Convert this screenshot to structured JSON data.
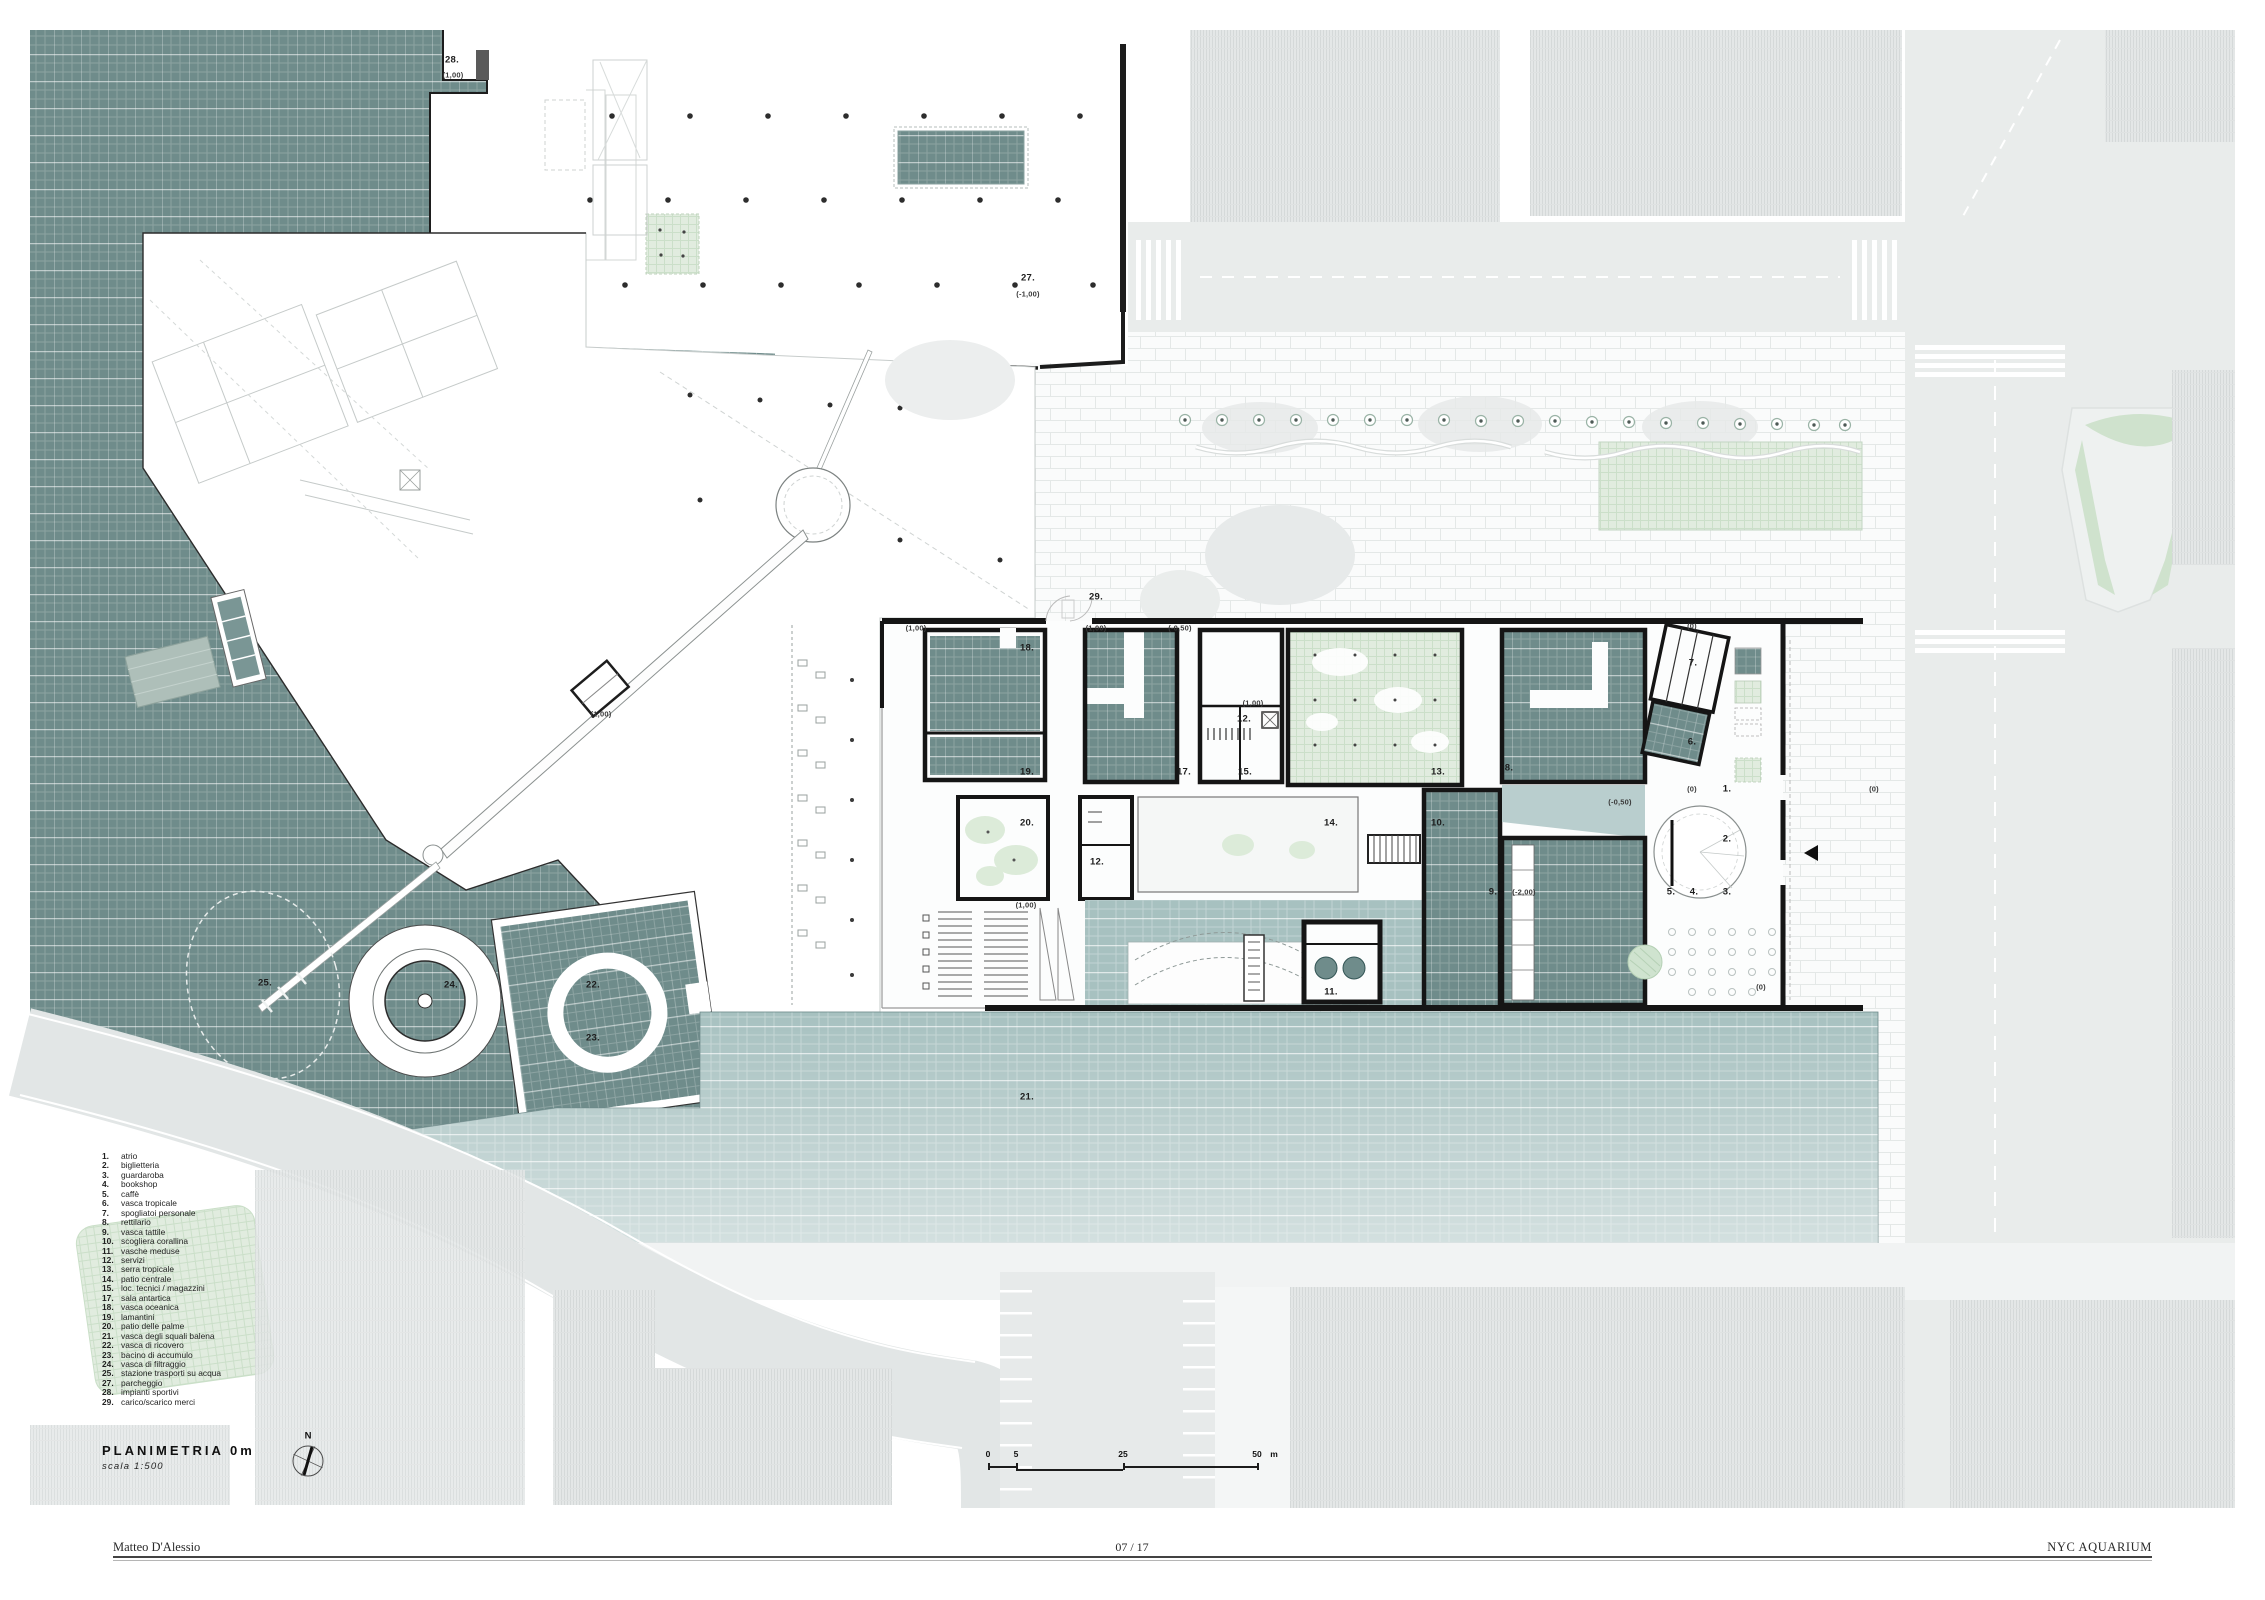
{
  "title_block": {
    "title": "PLANIMETRIA 0m",
    "scale": "scala 1:500",
    "north_label": "N"
  },
  "scale_bar": {
    "labels": [
      {
        "text": "0",
        "x": 988
      },
      {
        "text": "5",
        "x": 1016
      },
      {
        "text": "25",
        "x": 1123
      },
      {
        "text": "50",
        "x": 1257
      },
      {
        "text": "m",
        "x": 1274
      }
    ]
  },
  "legend": {
    "items": [
      {
        "num": "1.",
        "label": "atrio"
      },
      {
        "num": "2.",
        "label": "biglietteria"
      },
      {
        "num": "3.",
        "label": "guardaroba"
      },
      {
        "num": "4.",
        "label": "bookshop"
      },
      {
        "num": "5.",
        "label": "caffè"
      },
      {
        "num": "6.",
        "label": "vasca tropicale"
      },
      {
        "num": "7.",
        "label": "spogliatoi personale"
      },
      {
        "num": "8.",
        "label": "rettilario"
      },
      {
        "num": "9.",
        "label": "vasca tattile"
      },
      {
        "num": "10.",
        "label": "scogliera corallina"
      },
      {
        "num": "11.",
        "label": "vasche meduse"
      },
      {
        "num": "12.",
        "label": "servizi"
      },
      {
        "num": "13.",
        "label": "serra tropicale"
      },
      {
        "num": "14.",
        "label": "patio centrale"
      },
      {
        "num": "15.",
        "label": "loc. tecnici / magazzini"
      },
      {
        "num": "17.",
        "label": "sala antartica"
      },
      {
        "num": "18.",
        "label": "vasca oceanica"
      },
      {
        "num": "19.",
        "label": "lamantini"
      },
      {
        "num": "20.",
        "label": "patio delle palme"
      },
      {
        "num": "21.",
        "label": "vasca degli squali balena"
      },
      {
        "num": "22.",
        "label": "vasca di ricovero"
      },
      {
        "num": "23.",
        "label": "bacino di accumulo"
      },
      {
        "num": "24.",
        "label": "vasca di filtraggio"
      },
      {
        "num": "25.",
        "label": "stazione trasporti su acqua"
      },
      {
        "num": "27.",
        "label": "parcheggio"
      },
      {
        "num": "28.",
        "label": "impianti sportivi"
      },
      {
        "num": "29.",
        "label": "carico/scarico merci"
      }
    ]
  },
  "plan_labels": [
    {
      "text": "28.",
      "x": 452,
      "y": 60
    },
    {
      "text": "(1,00)",
      "x": 453,
      "y": 75,
      "small": true
    },
    {
      "text": "27.",
      "x": 1028,
      "y": 278
    },
    {
      "text": "(-1,00)",
      "x": 1028,
      "y": 294,
      "small": true
    },
    {
      "text": "29.",
      "x": 1096,
      "y": 597
    },
    {
      "text": "(1,00)",
      "x": 916,
      "y": 628,
      "small": true
    },
    {
      "text": "(1,00)",
      "x": 1096,
      "y": 628,
      "small": true
    },
    {
      "text": "(-0,50)",
      "x": 1180,
      "y": 628,
      "small": true
    },
    {
      "text": "(0)",
      "x": 1692,
      "y": 626,
      "small": true
    },
    {
      "text": "18.",
      "x": 1027,
      "y": 648
    },
    {
      "text": "19.",
      "x": 1027,
      "y": 772
    },
    {
      "text": "(1,00)",
      "x": 1253,
      "y": 703,
      "small": true
    },
    {
      "text": "12.",
      "x": 1244,
      "y": 719
    },
    {
      "text": "17.",
      "x": 1184,
      "y": 772
    },
    {
      "text": "15.",
      "x": 1245,
      "y": 772
    },
    {
      "text": "13.",
      "x": 1438,
      "y": 772
    },
    {
      "text": "20.",
      "x": 1027,
      "y": 823
    },
    {
      "text": "12.",
      "x": 1097,
      "y": 862
    },
    {
      "text": "14.",
      "x": 1331,
      "y": 823
    },
    {
      "text": "10.",
      "x": 1438,
      "y": 823
    },
    {
      "text": "(1,00)",
      "x": 1026,
      "y": 905,
      "small": true
    },
    {
      "text": "11.",
      "x": 1331,
      "y": 992
    },
    {
      "text": "21.",
      "x": 1027,
      "y": 1097
    },
    {
      "text": "8.",
      "x": 1509,
      "y": 768
    },
    {
      "text": "7.",
      "x": 1693,
      "y": 663
    },
    {
      "text": "6.",
      "x": 1692,
      "y": 742
    },
    {
      "text": "(0)",
      "x": 1692,
      "y": 789,
      "small": true
    },
    {
      "text": "1.",
      "x": 1727,
      "y": 789
    },
    {
      "text": "2.",
      "x": 1727,
      "y": 839
    },
    {
      "text": "(-0,50)",
      "x": 1620,
      "y": 802,
      "small": true
    },
    {
      "text": "9.",
      "x": 1493,
      "y": 892
    },
    {
      "text": "(-2,00)",
      "x": 1524,
      "y": 892,
      "small": true
    },
    {
      "text": "5.",
      "x": 1671,
      "y": 892
    },
    {
      "text": "4.",
      "x": 1694,
      "y": 892
    },
    {
      "text": "3.",
      "x": 1727,
      "y": 892
    },
    {
      "text": "(0)",
      "x": 1874,
      "y": 789,
      "small": true
    },
    {
      "text": "(0)",
      "x": 1761,
      "y": 987,
      "small": true
    },
    {
      "text": "(1,00)",
      "x": 601,
      "y": 714,
      "small": true
    },
    {
      "text": "25.",
      "x": 265,
      "y": 983
    },
    {
      "text": "24.",
      "x": 451,
      "y": 985
    },
    {
      "text": "22.",
      "x": 593,
      "y": 985
    },
    {
      "text": "23.",
      "x": 593,
      "y": 1038
    }
  ],
  "footer": {
    "author": "Matteo D'Alessio",
    "page": "07 / 17",
    "project": "NYC AQUARIUM"
  },
  "colors": {
    "water": "#6f8c8b",
    "pool": "#a7c1c0",
    "green": "#e1ecdf",
    "wall": "#151515"
  }
}
